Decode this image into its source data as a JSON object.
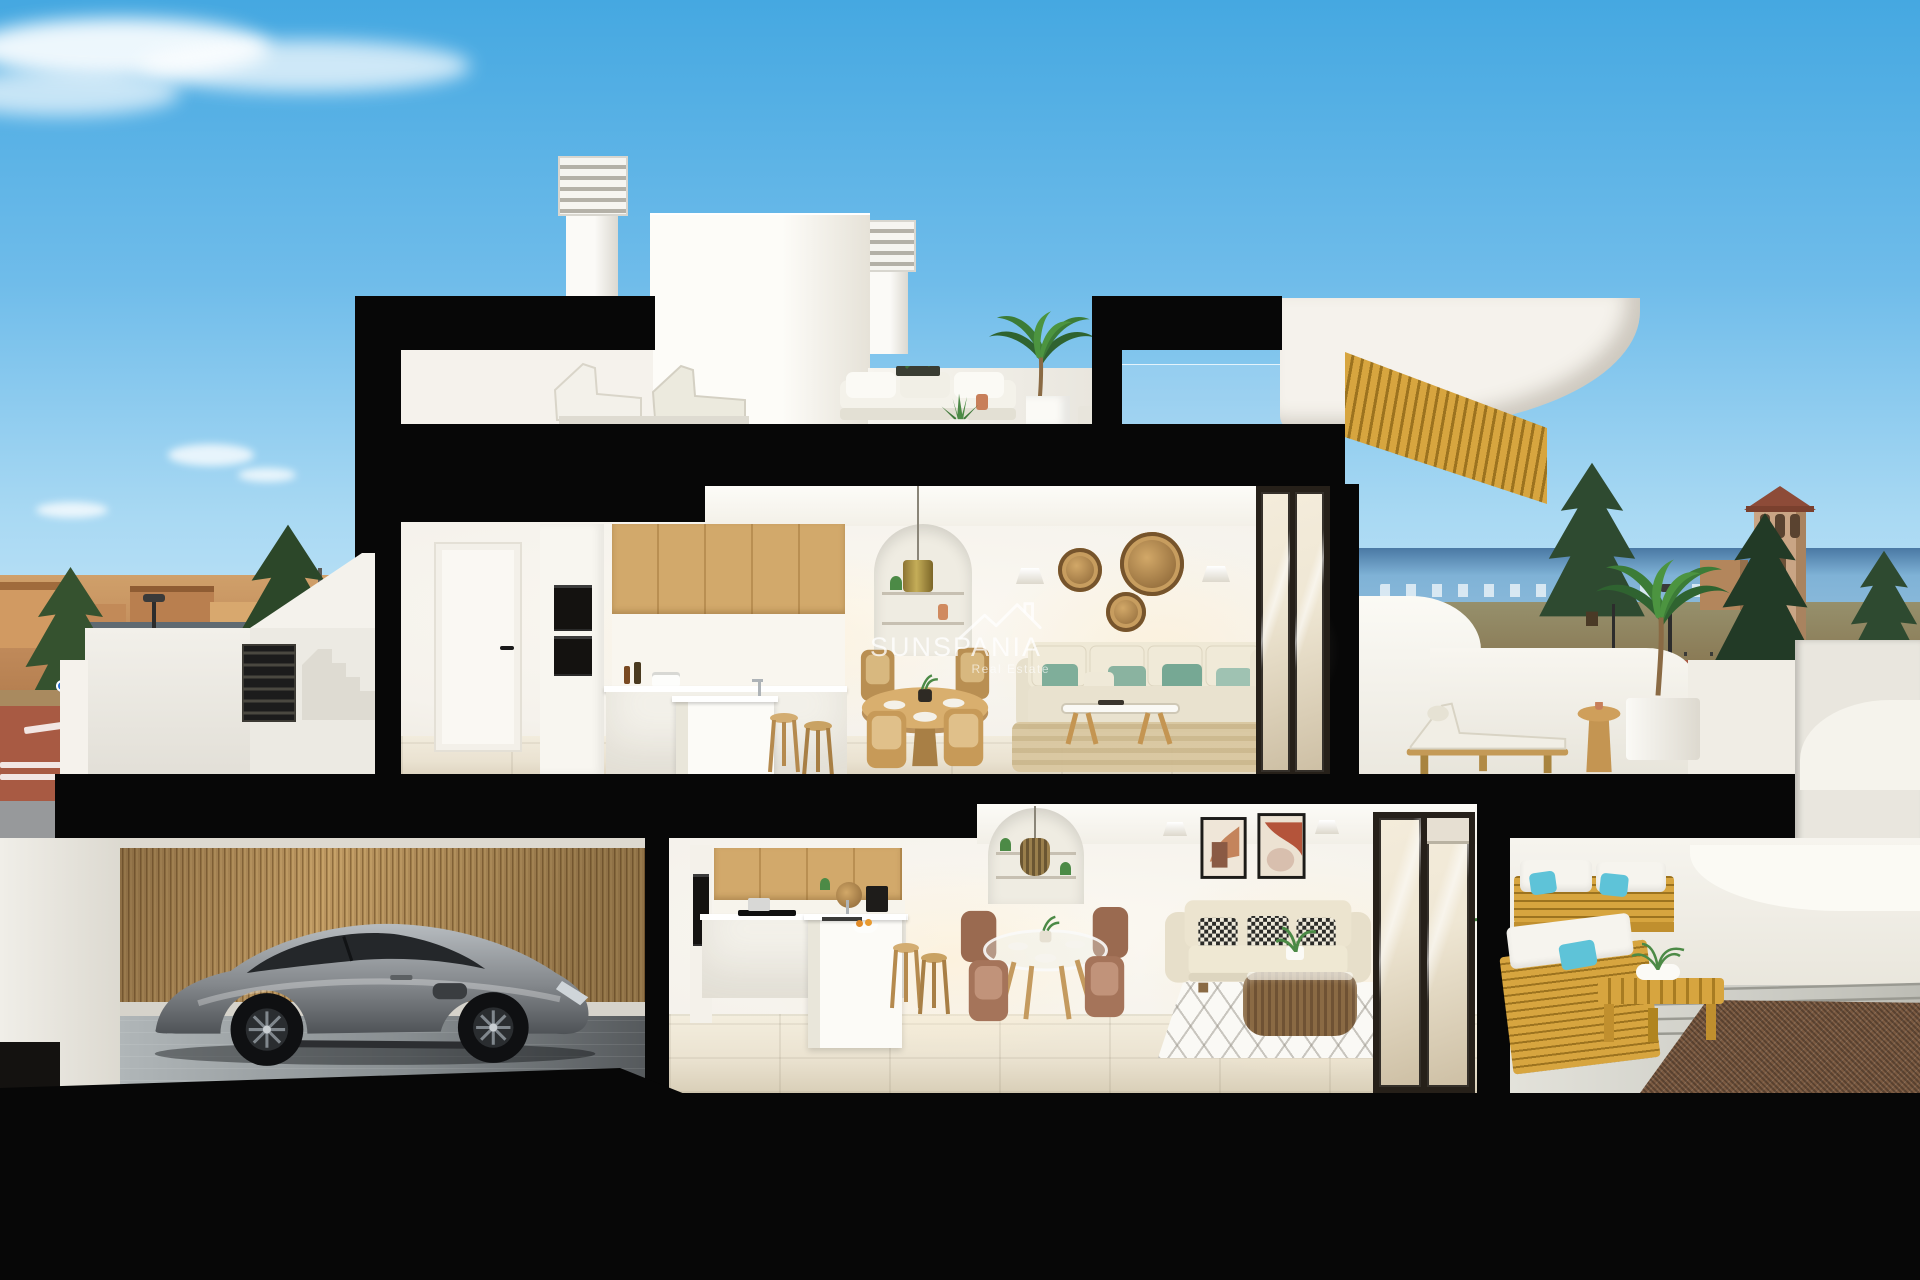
{
  "watermark": {
    "brand": "SUNSPANIA",
    "tagline": "Real Estate",
    "logo": "roofline-logo"
  },
  "scene": {
    "type": "3d-cutaway-render",
    "subject": "two-storey duplex cross-section with garage, kitchens, living rooms, terraces and roof deck"
  },
  "palette": {
    "sky_top": "#45a8e1",
    "sky_mid": "#6fbcea",
    "sky_low": "#a9d9f3",
    "sky_horizon": "#cfeaf8",
    "cut": "#070707",
    "wall": "#f5f2ec",
    "wall_dim": "#e6e2d8",
    "wall_bright": "#fdfcf8",
    "wood": "#d2a96b",
    "reed": "#b08c55",
    "floor_up": "#eae2d1",
    "floor_low": "#ebe3d1",
    "green": "#7fae9a",
    "teal": "#5ec3d8",
    "car": "#85898d",
    "sea": "#7fb2d6",
    "mountain": "#4a79a4",
    "tree": "#2e4a30",
    "town": "#c08a5a",
    "road": "#a85a43",
    "road_gray": "#97999b",
    "tile": "#8d4b38",
    "patio": "#cdcdc6",
    "gravel": "#7b5a41",
    "frame_dark": "#262019",
    "gold": "#ab9146",
    "slat_yellow": "#d7a53f",
    "slat_shadow": "#9c731f",
    "glass_warm": "#efe7d4"
  }
}
